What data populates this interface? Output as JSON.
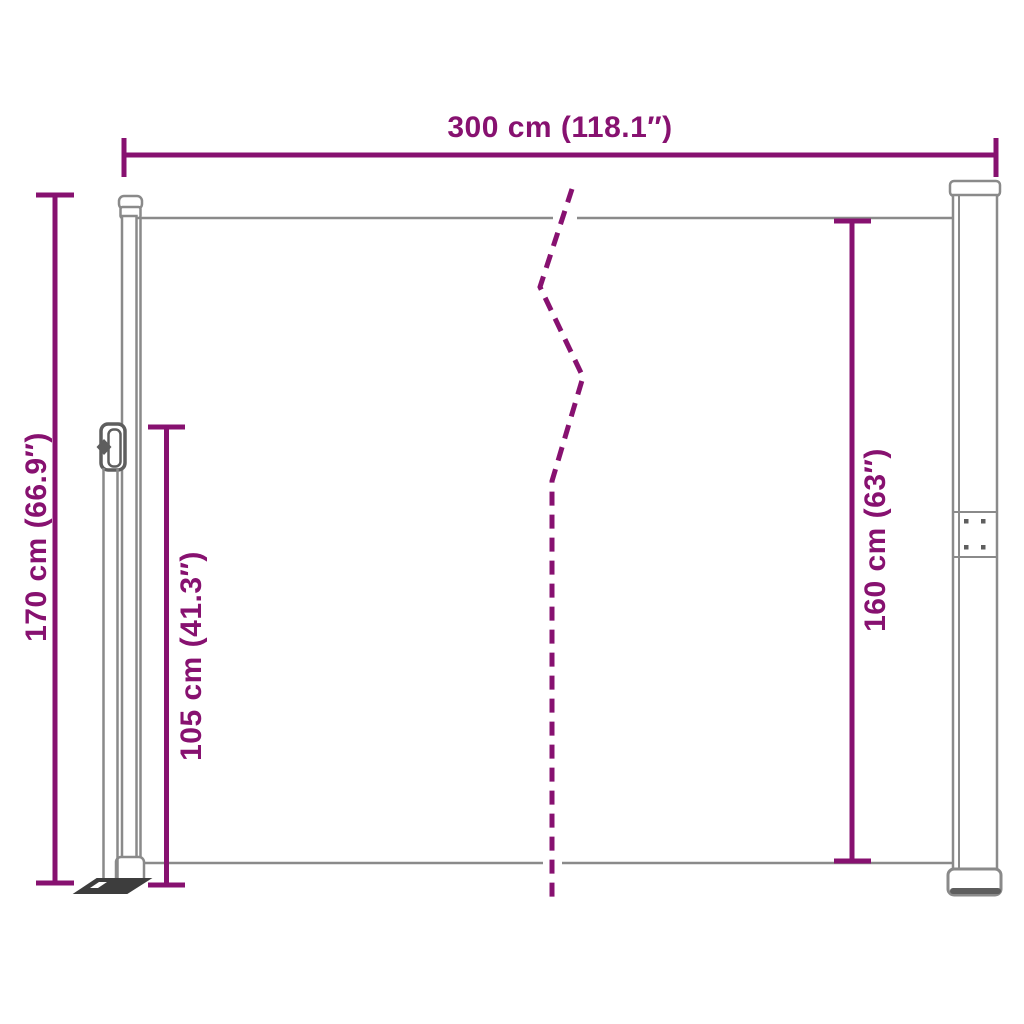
{
  "diagram": {
    "dimensions": {
      "total_width": {
        "label": "300 cm (118.1″)"
      },
      "total_height": {
        "label": "170 cm (66.9″)"
      },
      "screen_height": {
        "label": "105 cm (41.3″)"
      },
      "cassette_height": {
        "label": "160 cm (63″)"
      }
    },
    "colors": {
      "dimension": "#871170",
      "outline": "#8A8A8A",
      "outline_dark": "#5E5E5E",
      "plate": "#3D3D3D",
      "background": "#FFFFFF"
    }
  }
}
